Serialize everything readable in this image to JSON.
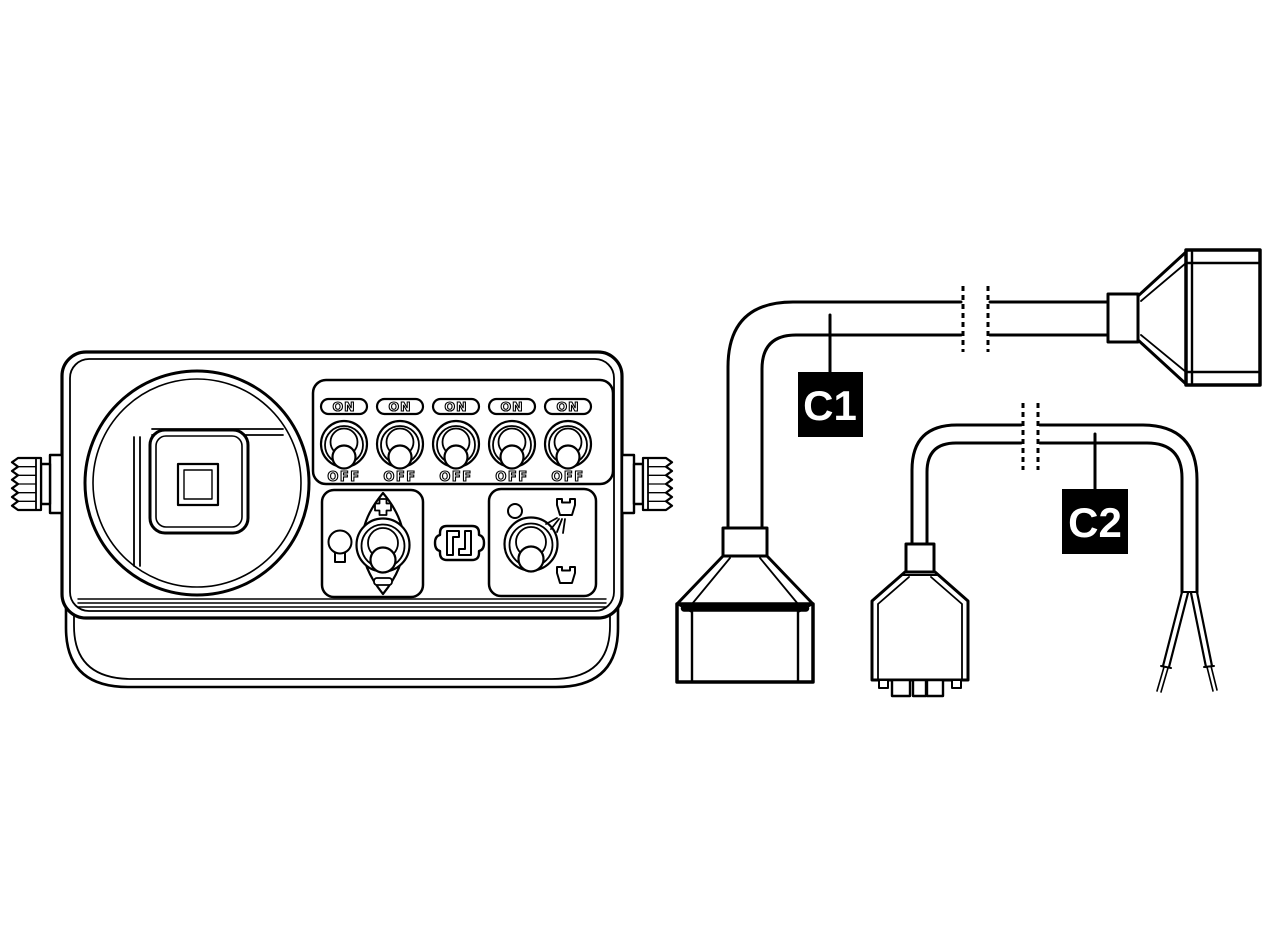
{
  "colors": {
    "background": "#ffffff",
    "line": "#000000",
    "label_bg": "#000000",
    "label_text": "#ffffff"
  },
  "console": {
    "switch_bank": {
      "switches": [
        {
          "on": "ON",
          "off": "OFF"
        },
        {
          "on": "ON",
          "off": "OFF"
        },
        {
          "on": "ON",
          "off": "OFF"
        },
        {
          "on": "ON",
          "off": "OFF"
        },
        {
          "on": "ON",
          "off": "OFF"
        }
      ]
    },
    "dimmer": {
      "plus": "+",
      "minus": "−"
    }
  },
  "cables": {
    "c1": {
      "label": "C1"
    },
    "c2": {
      "label": "C2"
    }
  },
  "icons": {
    "bulb-icon": "lamp: circle with stem base",
    "plus-icon": "+",
    "minus-icon": "−",
    "harness-plug-icon": "interlocked plug contacts",
    "indicator-dot-icon": "small circle",
    "nozzle-spraying-icon": "spray tip with fan lines",
    "nozzle-icon": "spray tip",
    "toggle-switch-icon": "round bezel toggle",
    "thumb-knob-icon": "ribbed mounting knob",
    "cable-break-icon": "double dashed break marks",
    "bare-wires-icon": "two stripped wire ends"
  }
}
